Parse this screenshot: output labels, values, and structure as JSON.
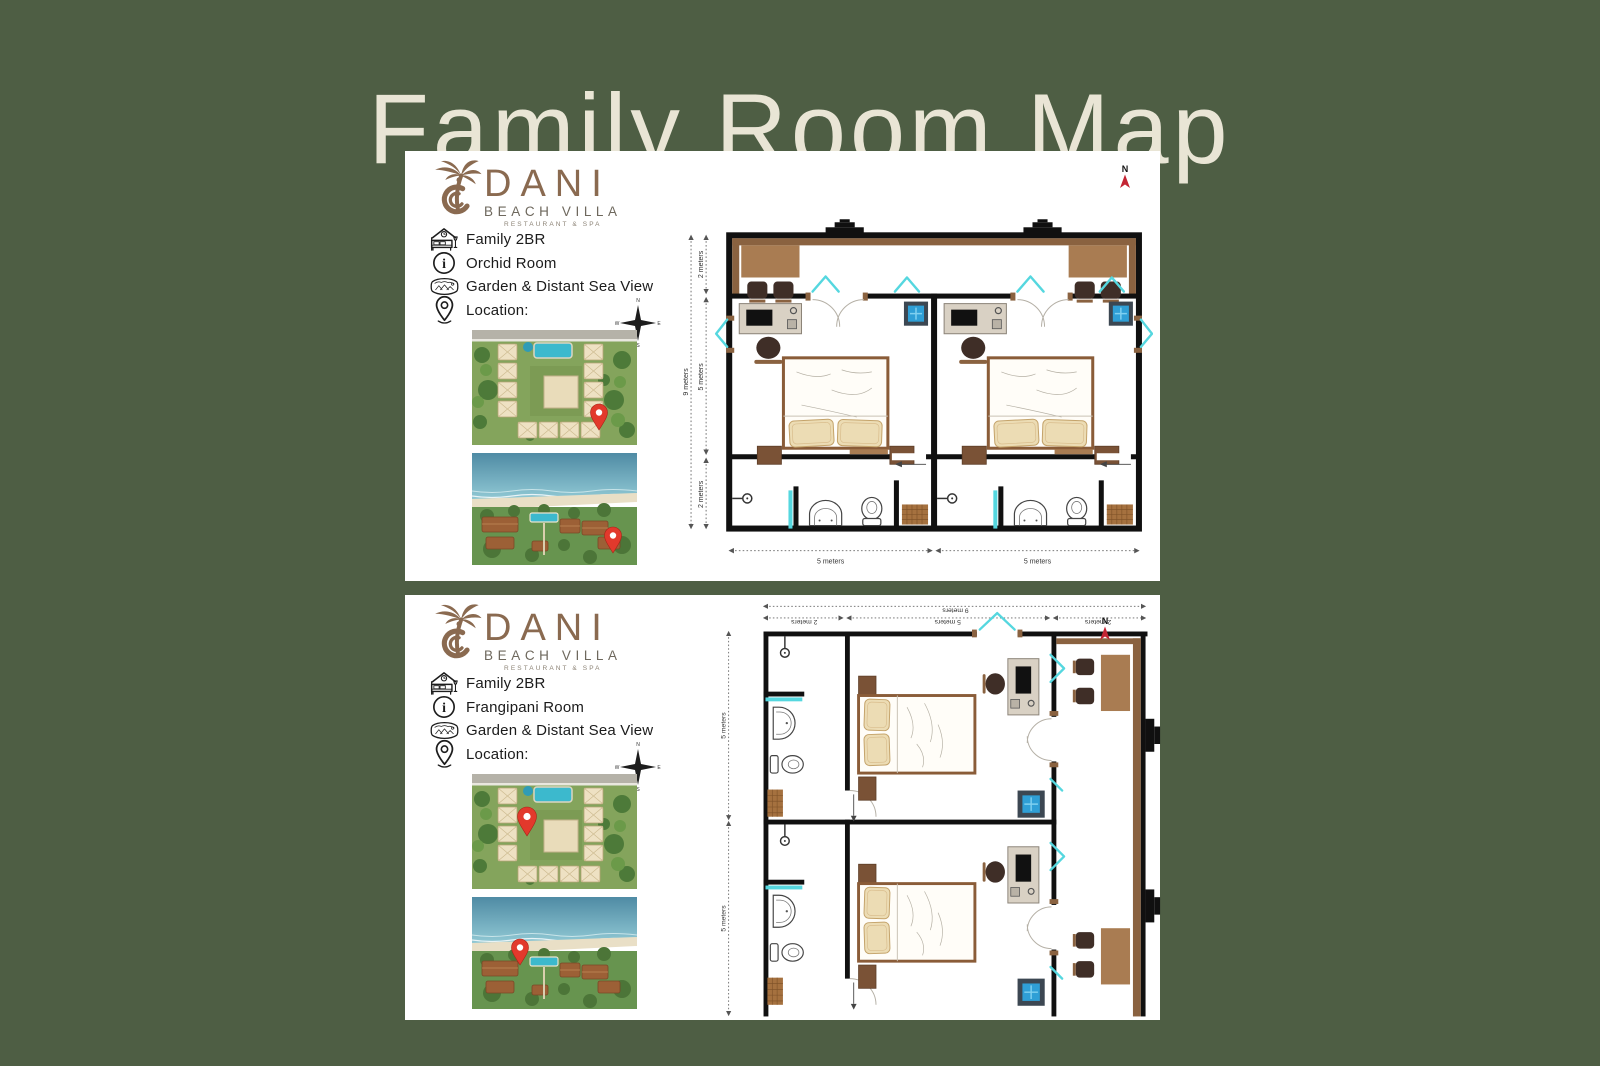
{
  "page": {
    "title": "Family Room Map"
  },
  "brand": {
    "name": "DANI",
    "subtitle": "BEACH VILLA",
    "tagline": "RESTAURANT & SPA"
  },
  "compass_rose": {
    "north": "N",
    "east": "E",
    "south": "S",
    "west": "W"
  },
  "north_indicator": {
    "label": "N"
  },
  "panels": [
    {
      "room": "Orchid Room",
      "details": [
        {
          "icon": "bed-icon",
          "label": "Family 2BR"
        },
        {
          "icon": "info-icon",
          "label": "Orchid Room"
        },
        {
          "icon": "panorama-view-icon",
          "label": "Garden & Distant Sea View"
        },
        {
          "icon": "location-pin-icon",
          "label": "Location:"
        }
      ],
      "floorplan": {
        "dimensions": {
          "total_depth": "9 meters",
          "terrace_depth": "2 meters",
          "bedroom_depth": "5 meters",
          "bathroom_depth": "2 meters",
          "room_width_left": "5 meters",
          "room_width_right": "5 meters"
        }
      }
    },
    {
      "room": "Frangipani Room",
      "details": [
        {
          "icon": "bed-icon",
          "label": "Family 2BR"
        },
        {
          "icon": "info-icon",
          "label": "Frangipani Room"
        },
        {
          "icon": "panorama-view-icon",
          "label": "Garden & Distant Sea View"
        },
        {
          "icon": "location-pin-icon",
          "label": "Location:"
        }
      ],
      "floorplan": {
        "dimensions": {
          "total_width": "9 meters",
          "bathroom_width": "2 meters",
          "bedroom_width": "5 meters",
          "terrace_width": "2 meters",
          "room_depth_top": "5 meters",
          "room_depth_bottom": "5 meters"
        }
      }
    }
  ],
  "colors": {
    "background": "#4e5e44",
    "title_text": "#e9e5d5",
    "panel": "#ffffff",
    "logo_brown": "#8a6a50",
    "wall_black": "#101010",
    "terrace_brown": "#8a6240",
    "table_brown": "#a97c52",
    "chair_dark": "#3f2e27",
    "desk_beige": "#d9d1c4",
    "bed_frame_brown": "#8a5c38",
    "pillow_beige": "#ecdcb4",
    "window_cyan": "#55d7df",
    "safe_blue": "#2f9fd6",
    "north_red": "#c32433",
    "pin_red": "#e2392c"
  }
}
